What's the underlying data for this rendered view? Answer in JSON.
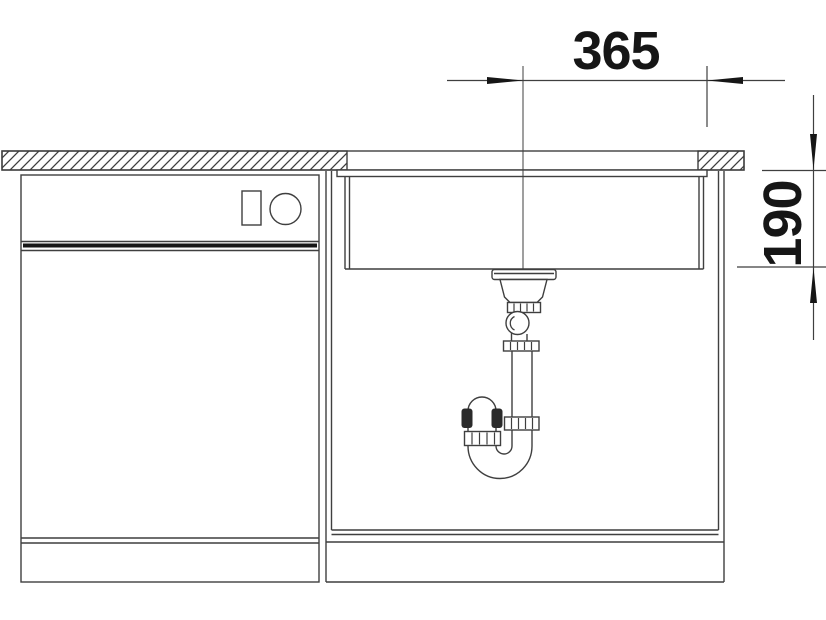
{
  "drawing": {
    "kind": "sink-installation-section",
    "dimensions": {
      "horizontal": {
        "value": "365",
        "unit_note": "",
        "orientation": "horizontal"
      },
      "vertical": {
        "value": "190",
        "unit_note": "",
        "orientation": "vertical-rotated"
      }
    },
    "colors": {
      "line": "#3f3f3f",
      "ink": "#161616",
      "background": "#ffffff"
    }
  }
}
